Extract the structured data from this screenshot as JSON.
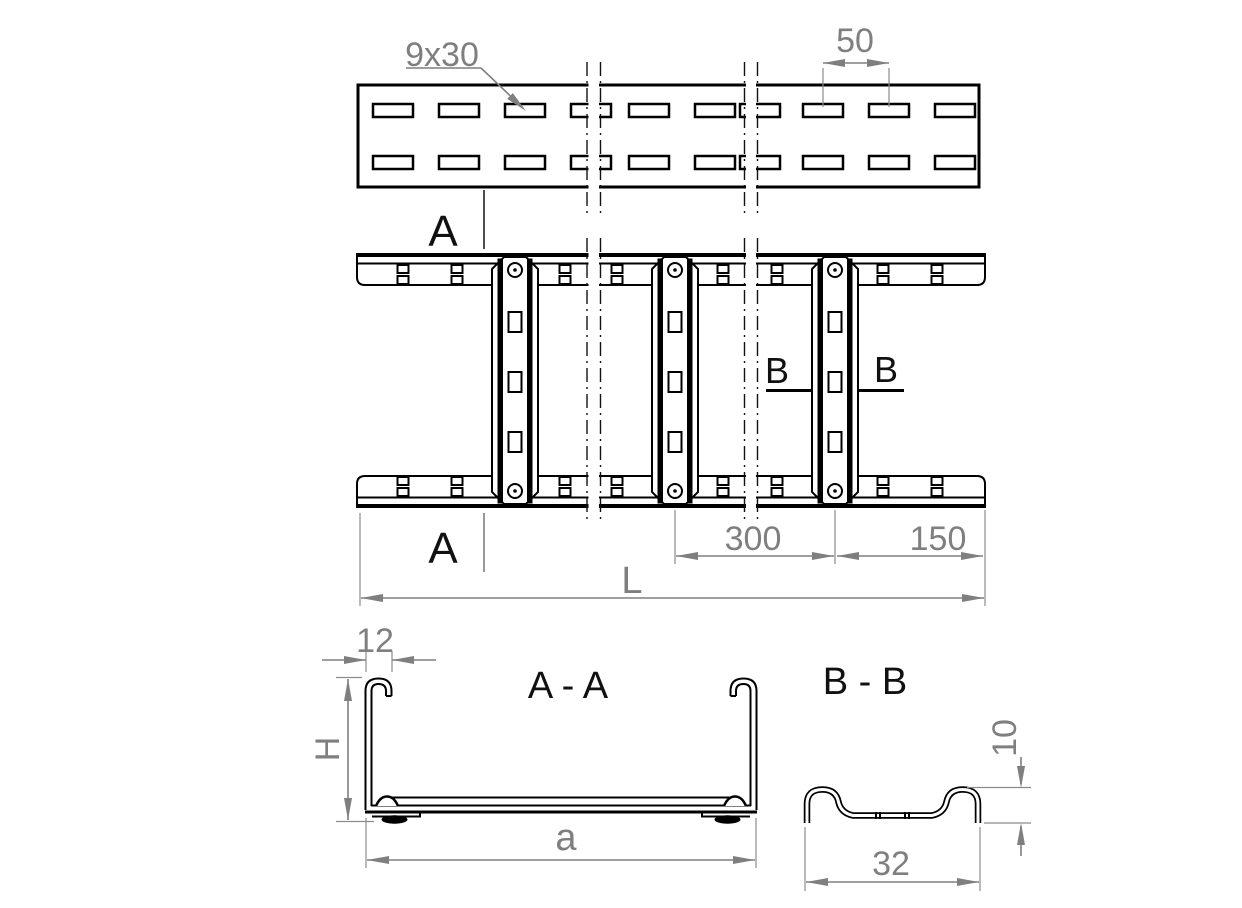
{
  "drawing": {
    "type": "technical-drawing-cable-ladder",
    "colors": {
      "line": "#000000",
      "dimension": "#7f7f7f",
      "background": "#ffffff"
    },
    "top_view": {
      "name": "side view of perforated rail",
      "slot_size": "9x30",
      "slot_pitch": "50"
    },
    "plan_view": {
      "name": "plan view of ladder with rungs",
      "section_a": "A",
      "section_b": "B",
      "rung_spacing": "300",
      "end_offset": "150",
      "length": "L"
    },
    "section_aa": {
      "title": "A - A",
      "lip_width": "12",
      "height": "H",
      "width": "a"
    },
    "section_bb": {
      "title": "B - B",
      "rung_height": "10",
      "rung_width": "32"
    }
  }
}
